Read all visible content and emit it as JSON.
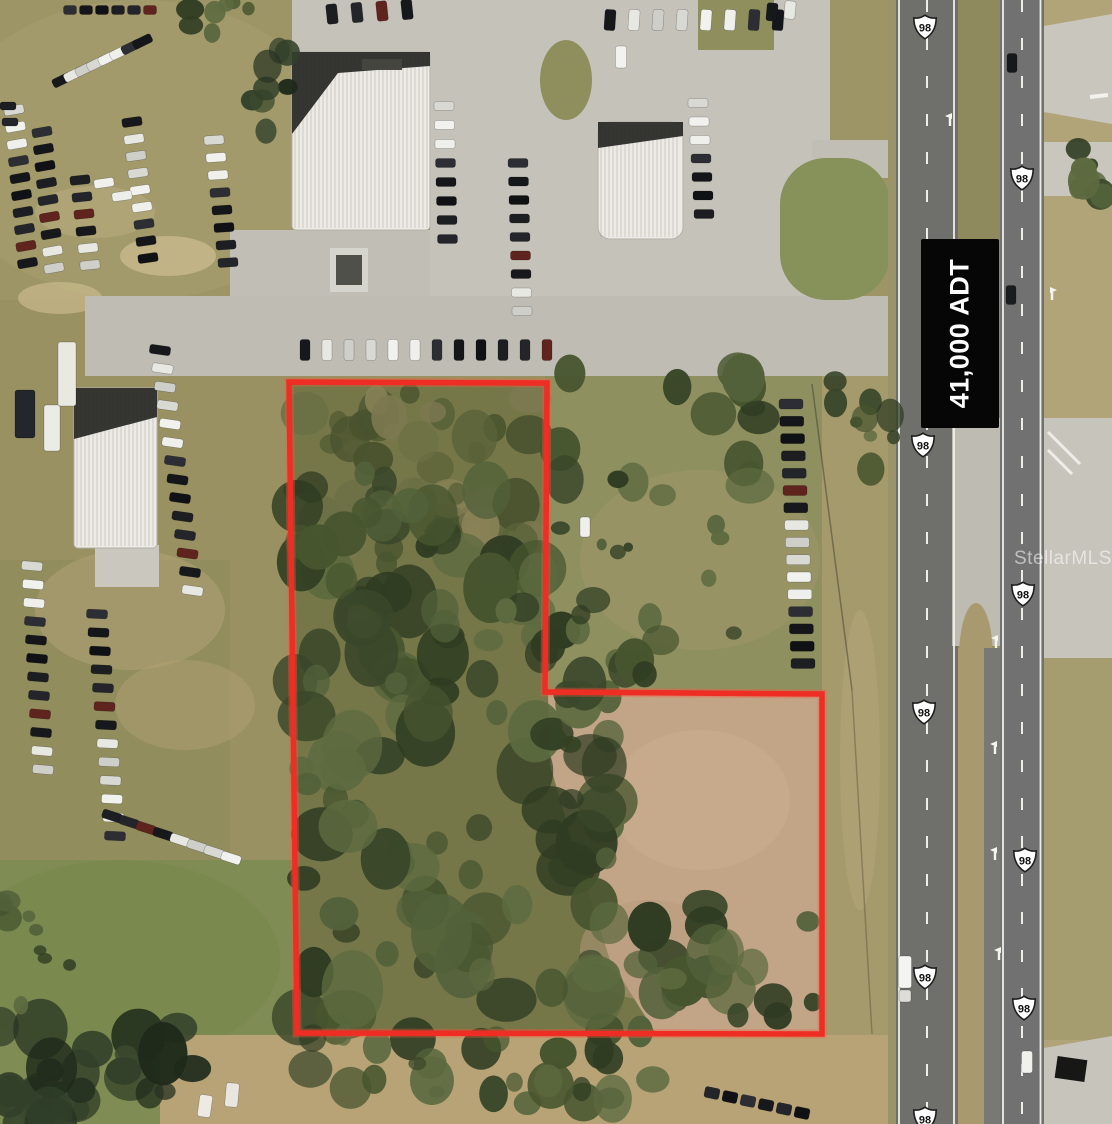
{
  "labels": {
    "traffic_count": "41,000 ADT",
    "watermark": "StellarMLS",
    "route_number": "98"
  },
  "colors": {
    "boundary": "#ee2d24",
    "boundary_glow": "rgba(255,90,60,0.35)",
    "sign_bg": "#060606",
    "sign_text": "#ffffff",
    "asphalt": "#6f706c",
    "pavement": "#c5c3b9",
    "shield_fill": "#ffffff",
    "shield_stroke": "#1f1f1f",
    "marking": "#f5f5f0"
  },
  "boundary": {
    "points": [
      [
        289,
        382
      ],
      [
        547,
        383
      ],
      [
        545,
        692
      ],
      [
        822,
        694
      ],
      [
        822,
        1034
      ],
      [
        297,
        1033
      ]
    ]
  },
  "shields": [
    [
      925,
      27
    ],
    [
      1022,
      178
    ],
    [
      923,
      445
    ],
    [
      1023,
      594
    ],
    [
      924,
      712
    ],
    [
      1025,
      860
    ],
    [
      925,
      977
    ],
    [
      1024,
      1008
    ],
    [
      925,
      1119
    ]
  ],
  "scene": {
    "terrain": [
      {
        "t": "rect",
        "x": 0,
        "y": 0,
        "w": 1112,
        "h": 1124,
        "f": "#9a9162"
      },
      {
        "t": "rect",
        "x": 0,
        "y": 0,
        "w": 900,
        "h": 300,
        "f": "#a09768",
        "o": 0.6
      },
      {
        "t": "ell",
        "x": 140,
        "y": 150,
        "rx": 200,
        "ry": 150,
        "f": "#a89f70",
        "o": 0.5
      },
      {
        "t": "rect",
        "x": 0,
        "y": 560,
        "w": 230,
        "h": 320,
        "f": "#8f8c5c",
        "o": 0.8
      },
      {
        "t": "rect",
        "x": 0,
        "y": 860,
        "w": 310,
        "h": 264,
        "f": "#7f8c53"
      },
      {
        "t": "ell",
        "x": 120,
        "y": 960,
        "rx": 160,
        "ry": 100,
        "f": "#79894e",
        "o": 0.8
      },
      {
        "t": "poly",
        "p": [
          [
            545,
            372
          ],
          [
            900,
            372
          ],
          [
            900,
            700
          ],
          [
            545,
            700
          ]
        ],
        "f": "#8f9060"
      },
      {
        "t": "ell",
        "x": 700,
        "y": 560,
        "rx": 120,
        "ry": 90,
        "f": "#9a9466",
        "o": 0.7
      },
      {
        "t": "poly",
        "p": [
          [
            289,
            382
          ],
          [
            547,
            383
          ],
          [
            545,
            692
          ],
          [
            822,
            694
          ],
          [
            822,
            1034
          ],
          [
            297,
            1033
          ]
        ],
        "f": "#757748"
      },
      {
        "t": "poly",
        "p": [
          [
            548,
            695
          ],
          [
            820,
            696
          ],
          [
            820,
            1032
          ],
          [
            655,
            1032
          ],
          [
            610,
            960
          ],
          [
            575,
            850
          ],
          [
            550,
            765
          ]
        ],
        "f": "#c2a487"
      },
      {
        "t": "ell",
        "x": 700,
        "y": 800,
        "rx": 90,
        "ry": 70,
        "f": "#cbaf92",
        "o": 0.5
      },
      {
        "t": "ell",
        "x": 650,
        "y": 950,
        "rx": 70,
        "ry": 50,
        "f": "#b89a7c",
        "o": 0.5
      },
      {
        "t": "rect",
        "x": 822,
        "y": 376,
        "w": 74,
        "h": 748,
        "f": "#a59a6b"
      },
      {
        "t": "ell",
        "x": 860,
        "y": 760,
        "rx": 20,
        "ry": 150,
        "f": "#b2a577",
        "o": 0.6
      },
      {
        "t": "rect",
        "x": 1044,
        "y": 0,
        "w": 68,
        "h": 1124,
        "f": "#b1a478"
      },
      {
        "t": "rect",
        "x": 1044,
        "y": 620,
        "w": 68,
        "h": 420,
        "f": "#a39a6d",
        "o": 0.8
      },
      {
        "t": "poly",
        "p": [
          [
            160,
            1035
          ],
          [
            900,
            1035
          ],
          [
            900,
            1124
          ],
          [
            160,
            1124
          ]
        ],
        "f": "#b7a376"
      },
      {
        "t": "ell",
        "x": 168,
        "y": 256,
        "rx": 48,
        "ry": 20,
        "f": "#c9b98c",
        "o": 0.8
      },
      {
        "t": "ell",
        "x": 60,
        "y": 298,
        "rx": 42,
        "ry": 16,
        "f": "#c9b98c",
        "o": 0.7
      },
      {
        "t": "ell",
        "x": 130,
        "y": 610,
        "rx": 95,
        "ry": 60,
        "f": "#b3a276",
        "o": 0.55
      },
      {
        "t": "ell",
        "x": 185,
        "y": 705,
        "rx": 70,
        "ry": 45,
        "f": "#b3a276",
        "o": 0.45
      },
      {
        "t": "ell",
        "x": 95,
        "y": 212,
        "rx": 60,
        "ry": 26,
        "f": "#bcae80",
        "o": 0.5
      }
    ],
    "pavement": [
      {
        "t": "rect",
        "x": 430,
        "y": 0,
        "w": 400,
        "h": 336,
        "f": "#c5c3b9"
      },
      {
        "t": "rect",
        "x": 292,
        "y": 0,
        "w": 138,
        "h": 52,
        "f": "#c5c3b9"
      },
      {
        "t": "rect",
        "x": 230,
        "y": 230,
        "w": 200,
        "h": 106,
        "f": "#c1bfb5"
      },
      {
        "t": "rect",
        "x": 85,
        "y": 296,
        "w": 817,
        "h": 80,
        "f": "#bfbdb3"
      },
      {
        "t": "rect",
        "x": 812,
        "y": 140,
        "w": 90,
        "h": 38,
        "f": "#c1bfb5"
      },
      {
        "t": "rect",
        "x": 780,
        "y": 158,
        "w": 110,
        "h": 142,
        "r": 46,
        "f": "#87915a"
      },
      {
        "t": "ell",
        "x": 566,
        "y": 80,
        "rx": 26,
        "ry": 40,
        "f": "#8f8f5e"
      },
      {
        "t": "rect",
        "x": 698,
        "y": 0,
        "w": 76,
        "h": 50,
        "f": "#8f8f5e"
      },
      {
        "t": "rect",
        "x": 95,
        "y": 545,
        "w": 64,
        "h": 42,
        "f": "#cac8be"
      },
      {
        "t": "rect",
        "x": 888,
        "y": 0,
        "w": 8,
        "h": 1124,
        "f": "#9c9469"
      },
      {
        "t": "rect",
        "x": 896,
        "y": 0,
        "w": 62,
        "h": 1124,
        "f": "#6f706c"
      },
      {
        "t": "rect",
        "x": 958,
        "y": 0,
        "w": 42,
        "h": 1124,
        "f": "#8f8a5e"
      },
      {
        "t": "rect",
        "x": 958,
        "y": 648,
        "w": 42,
        "h": 476,
        "f": "#a89a6e"
      },
      {
        "t": "rect",
        "x": 952,
        "y": 418,
        "w": 60,
        "h": 228,
        "f": "#bdbbb2"
      },
      {
        "t": "ell",
        "x": 976,
        "y": 658,
        "rx": 17,
        "ry": 55,
        "f": "#a89a6e"
      },
      {
        "t": "rect",
        "x": 984,
        "y": 648,
        "w": 16,
        "h": 476,
        "f": "#787974"
      },
      {
        "t": "rect",
        "x": 1000,
        "y": 0,
        "w": 44,
        "h": 1124,
        "f": "#707170"
      },
      {
        "t": "poly",
        "p": [
          [
            1044,
            26
          ],
          [
            1112,
            14
          ],
          [
            1112,
            124
          ],
          [
            1044,
            112
          ]
        ],
        "f": "#c8c6bd"
      },
      {
        "t": "rect",
        "x": 1044,
        "y": 142,
        "w": 68,
        "h": 54,
        "f": "#c8c6bd"
      },
      {
        "t": "rect",
        "x": 1044,
        "y": 418,
        "w": 68,
        "h": 240,
        "f": "#c6c4bb"
      },
      {
        "t": "poly",
        "p": [
          [
            1044,
            1048
          ],
          [
            1112,
            1036
          ],
          [
            1112,
            1124
          ],
          [
            1044,
            1124
          ]
        ],
        "f": "#c6c4bb"
      }
    ],
    "lines": [
      {
        "x1": 899,
        "y1": 0,
        "x2": 899,
        "y2": 1124,
        "w": 1.8
      },
      {
        "x1": 954,
        "y1": 0,
        "x2": 954,
        "y2": 1124,
        "w": 1.8
      },
      {
        "x1": 927,
        "y1": 0,
        "x2": 927,
        "y2": 1124,
        "w": 2,
        "d": "12 26"
      },
      {
        "x1": 1003,
        "y1": 0,
        "x2": 1003,
        "y2": 1124,
        "w": 1.8
      },
      {
        "x1": 1040.5,
        "y1": 0,
        "x2": 1040.5,
        "y2": 1124,
        "w": 1.8
      },
      {
        "x1": 1022,
        "y1": 0,
        "x2": 1022,
        "y2": 1124,
        "w": 2,
        "d": "12 26"
      },
      {
        "x1": 1048,
        "y1": 432,
        "x2": 1080,
        "y2": 464,
        "w": 3,
        "o": 0.85
      },
      {
        "x1": 1048,
        "y1": 450,
        "x2": 1072,
        "y2": 474,
        "w": 3,
        "o": 0.85
      },
      {
        "x1": 1090,
        "y1": 97,
        "x2": 1108,
        "y2": 95,
        "w": 4
      },
      {
        "x1": 812,
        "y1": 384,
        "x2": 852,
        "y2": 690,
        "w": 1.5,
        "c": "#3f3f30",
        "o": 0.5
      },
      {
        "x1": 852,
        "y1": 690,
        "x2": 872,
        "y2": 1034,
        "w": 1.5,
        "c": "#3f3f30",
        "o": 0.35
      }
    ],
    "arrows": [
      {
        "x": 950,
        "y": 118
      },
      {
        "x": 996,
        "y": 640
      },
      {
        "x": 995,
        "y": 746
      },
      {
        "x": 995,
        "y": 852
      },
      {
        "x": 999,
        "y": 952
      },
      {
        "x": 1052,
        "y": 292,
        "m": 1
      }
    ],
    "buildings": [
      {
        "x": 292,
        "y": 52,
        "w": 138,
        "h": 178,
        "r": 4,
        "dark": [
          [
            292,
            52
          ],
          [
            430,
            52
          ],
          [
            430,
            66
          ],
          [
            338,
            73
          ],
          [
            292,
            134
          ]
        ],
        "vent": [
          362,
          59,
          40,
          11
        ]
      },
      {
        "x": 598,
        "y": 122,
        "w": 85,
        "h": 117,
        "r": 12,
        "dark": [
          [
            598,
            122
          ],
          [
            683,
            122
          ],
          [
            683,
            136
          ],
          [
            598,
            148
          ]
        ]
      },
      {
        "x": 74,
        "y": 388,
        "w": 83,
        "h": 160,
        "r": 4,
        "dark": [
          [
            74,
            388
          ],
          [
            157,
            388
          ],
          [
            157,
            417
          ],
          [
            74,
            439
          ]
        ]
      }
    ],
    "car_rows": [
      {
        "x": 62,
        "y": 80,
        "dx": 11.5,
        "dy": -5.5,
        "n": 8,
        "w": 20,
        "h": 9,
        "a": -26
      },
      {
        "x": 14,
        "y": 110,
        "dx": 1.5,
        "dy": 17,
        "n": 10,
        "w": 20,
        "h": 9,
        "a": -10
      },
      {
        "x": 42,
        "y": 132,
        "dx": 1.5,
        "dy": 17,
        "n": 9,
        "w": 20,
        "h": 9,
        "a": -10
      },
      {
        "x": 80,
        "y": 180,
        "dx": 2,
        "dy": 17,
        "n": 6,
        "w": 20,
        "h": 9,
        "a": -6
      },
      {
        "x": 132,
        "y": 122,
        "dx": 2,
        "dy": 17,
        "n": 9,
        "w": 20,
        "h": 9,
        "a": -8
      },
      {
        "x": 214,
        "y": 140,
        "dx": 2,
        "dy": 17.5,
        "n": 8,
        "w": 20,
        "h": 9,
        "a": -4
      },
      {
        "x": 70,
        "y": 10,
        "dx": 16,
        "dy": 0,
        "n": 6,
        "w": 13,
        "h": 9,
        "a": 0
      },
      {
        "x": 8,
        "y": 106,
        "dx": 2,
        "dy": 16,
        "n": 2,
        "w": 16,
        "h": 8,
        "a": 0
      },
      {
        "x": 160,
        "y": 350,
        "dx": 2.5,
        "dy": 18.5,
        "n": 14,
        "w": 21,
        "h": 9,
        "a": 8
      },
      {
        "x": 32,
        "y": 566,
        "dx": 1,
        "dy": 18.5,
        "n": 12,
        "w": 21,
        "h": 9,
        "a": 5
      },
      {
        "x": 97,
        "y": 614,
        "dx": 1.5,
        "dy": 18.5,
        "n": 13,
        "w": 21,
        "h": 9,
        "a": 3
      },
      {
        "x": 112,
        "y": 816,
        "dx": 17,
        "dy": 6,
        "n": 8,
        "w": 20,
        "h": 9,
        "a": 18
      },
      {
        "x": 305,
        "y": 350,
        "dx": 22,
        "dy": 0,
        "n": 12,
        "w": 10,
        "h": 21,
        "a": 0
      },
      {
        "x": 444,
        "y": 106,
        "dx": 0.5,
        "dy": 19,
        "n": 8,
        "w": 20,
        "h": 9,
        "a": 0
      },
      {
        "x": 518,
        "y": 163,
        "dx": 0.5,
        "dy": 18.5,
        "n": 9,
        "w": 20,
        "h": 9,
        "a": 0
      },
      {
        "x": 332,
        "y": 14,
        "dx": 25,
        "dy": -1.5,
        "n": 4,
        "w": 11,
        "h": 20,
        "a": -6
      },
      {
        "x": 610,
        "y": 20,
        "dx": 24,
        "dy": 0,
        "n": 8,
        "w": 11,
        "h": 21,
        "a": 4
      },
      {
        "x": 698,
        "y": 103,
        "dx": 1,
        "dy": 18.5,
        "n": 7,
        "w": 20,
        "h": 9,
        "a": 0
      },
      {
        "x": 791,
        "y": 404,
        "dx": 0.8,
        "dy": 17.3,
        "n": 16,
        "w": 24,
        "h": 10,
        "a": 0
      },
      {
        "x": 712,
        "y": 1093,
        "dx": 18,
        "dy": 4,
        "n": 6,
        "w": 15,
        "h": 11,
        "a": 12,
        "dark": 1
      },
      {
        "x": 772,
        "y": 12,
        "dx": 18,
        "dy": -2,
        "n": 2,
        "w": 11,
        "h": 18,
        "a": 5
      }
    ],
    "vehicles": [
      [
        585,
        527,
        10,
        20,
        0,
        "#eff0ec"
      ],
      [
        1012,
        63,
        10,
        19,
        0,
        "#17181a"
      ],
      [
        1011,
        295,
        10,
        19,
        0,
        "#1b1c1e"
      ],
      [
        1027,
        1062,
        11,
        22,
        0,
        "#f0f1ed"
      ],
      [
        621,
        57,
        11,
        22,
        0,
        "#f2f2ee"
      ],
      [
        905,
        972,
        13,
        32,
        0,
        "#f4f4f1"
      ],
      [
        905,
        996,
        12,
        12,
        0,
        "#dddcd6"
      ],
      [
        205,
        1106,
        13,
        22,
        8,
        "#eceae2"
      ],
      [
        232,
        1095,
        13,
        24,
        5,
        "#e8e6de"
      ],
      [
        16,
        1113,
        12,
        18,
        0,
        "#e5e3da"
      ],
      [
        52,
        428,
        16,
        46,
        0,
        "#ecece6"
      ],
      [
        25,
        414,
        20,
        48,
        0,
        "#23262b"
      ],
      [
        67,
        374,
        18,
        64,
        0,
        "#e9e8e1"
      ],
      [
        104,
        183,
        20,
        9,
        -8,
        "#f0f0ec"
      ],
      [
        122,
        196,
        20,
        9,
        -8,
        "#edeee9"
      ]
    ],
    "tree_regions": [
      {
        "x": 295,
        "y": 388,
        "X": 543,
        "Y": 560,
        "n": 48,
        "p": "scrub",
        "s": 7,
        "r0": 8,
        "r1": 26
      },
      {
        "x": 295,
        "y": 470,
        "X": 543,
        "Y": 695,
        "n": 55,
        "p": "dark",
        "s": 11,
        "r0": 10,
        "r1": 30
      },
      {
        "x": 300,
        "y": 692,
        "X": 620,
        "Y": 1032,
        "n": 70,
        "p": "dark",
        "s": 23,
        "r0": 10,
        "r1": 32
      },
      {
        "x": 560,
        "y": 360,
        "X": 760,
        "Y": 500,
        "n": 16,
        "p": "dark",
        "s": 31,
        "r0": 10,
        "r1": 26
      },
      {
        "x": 548,
        "y": 600,
        "X": 665,
        "Y": 695,
        "n": 14,
        "p": "dark",
        "s": 41,
        "r0": 8,
        "r1": 22
      },
      {
        "x": 640,
        "y": 900,
        "X": 818,
        "Y": 1032,
        "n": 22,
        "p": "dark",
        "s": 47,
        "r0": 8,
        "r1": 26
      },
      {
        "x": 310,
        "y": 1032,
        "X": 660,
        "Y": 1105,
        "n": 26,
        "p": "dark",
        "s": 53,
        "r0": 8,
        "r1": 24
      },
      {
        "x": 0,
        "y": 1025,
        "X": 210,
        "Y": 1124,
        "n": 26,
        "p": "deep",
        "s": 59,
        "r0": 10,
        "r1": 28
      },
      {
        "x": 0,
        "y": 880,
        "X": 70,
        "Y": 1010,
        "n": 10,
        "p": "dark",
        "s": 61,
        "r0": 6,
        "r1": 16
      },
      {
        "x": 1078,
        "y": 128,
        "X": 1112,
        "Y": 215,
        "n": 8,
        "p": "dark",
        "s": 67,
        "r0": 6,
        "r1": 16
      },
      {
        "x": 835,
        "y": 378,
        "X": 898,
        "Y": 470,
        "n": 9,
        "p": "dark",
        "s": 71,
        "r0": 6,
        "r1": 14
      },
      {
        "x": 190,
        "y": 0,
        "X": 262,
        "Y": 45,
        "n": 7,
        "p": "dark",
        "s": 73,
        "r0": 6,
        "r1": 15
      },
      {
        "x": 560,
        "y": 520,
        "X": 770,
        "Y": 660,
        "n": 8,
        "p": "dark",
        "s": 83,
        "r0": 4,
        "r1": 10
      },
      {
        "x": 252,
        "y": 48,
        "X": 295,
        "Y": 140,
        "n": 8,
        "p": "deep",
        "s": 89,
        "r0": 6,
        "r1": 16
      }
    ],
    "extras": [
      {
        "t": "rect",
        "x": 330,
        "y": 248,
        "w": 38,
        "h": 44,
        "f": "#d6d5cd",
        "nm": "canopy-structure"
      },
      {
        "t": "rect",
        "x": 336,
        "y": 255,
        "w": 26,
        "h": 30,
        "f": "#50504a",
        "nm": "canopy-roof"
      },
      {
        "t": "rect",
        "x": 1056,
        "y": 1058,
        "w": 30,
        "h": 22,
        "f": "#171715",
        "rot": 8,
        "nm": "billboard"
      }
    ],
    "palettes": {
      "cars": [
        "#17181b",
        "#eff0ec",
        "#23252a",
        "#d9d9d4",
        "#101114",
        "#e8e8e3",
        "#2c2e33",
        "#60241f",
        "#f1f1ee",
        "#1c1e22",
        "#cfcfca",
        "#14161a"
      ],
      "cars_dark": [
        "#17181b",
        "#23252a",
        "#101114",
        "#2c2e33"
      ],
      "scrub": [
        "#6b7045",
        "#5a6238",
        "#7c7850",
        "#49532e",
        "#8a8258"
      ],
      "dark": [
        "#47552f",
        "#3a472a",
        "#52613a",
        "#2f3c22",
        "#5d6a40"
      ],
      "deep": [
        "#32402a",
        "#273322",
        "#3c4a2e",
        "#1f2a1b"
      ]
    }
  }
}
